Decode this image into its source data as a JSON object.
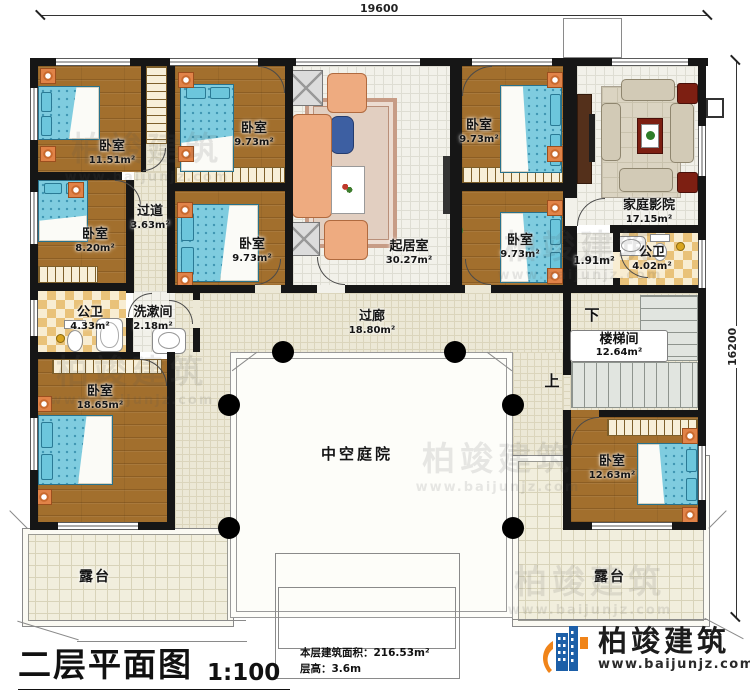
{
  "dimensions": {
    "top": "19600",
    "right": "16200"
  },
  "rooms": {
    "bedroom_tl": {
      "name": "卧室",
      "area": "11.51m²"
    },
    "bedroom_tm": {
      "name": "卧室",
      "area": "9.73m²"
    },
    "bedroom_tr": {
      "name": "卧室",
      "area": "9.73m²"
    },
    "home_theater": {
      "name": "家庭影院",
      "area": "17.15m²"
    },
    "bedroom_ml": {
      "name": "卧室",
      "area": "8.20m²"
    },
    "hallway": {
      "name": "过道",
      "area": "3.63m²"
    },
    "bedroom_mm": {
      "name": "卧室",
      "area": "9.73m²"
    },
    "living_room": {
      "name": "起居室",
      "area": "30.27m²"
    },
    "bedroom_mr": {
      "name": "卧室",
      "area": "9.73m²"
    },
    "bath_left": {
      "name": "公卫",
      "area": "4.33m²"
    },
    "washroom": {
      "name": "洗漱间",
      "area": "2.18m²"
    },
    "gallery": {
      "name": "过廊",
      "area": "18.80m²"
    },
    "vestibule": {
      "area": "1.91m²"
    },
    "bath_right": {
      "name": "公卫",
      "area": "4.02m²"
    },
    "stairwell": {
      "name": "楼梯间",
      "area": "12.64m²"
    },
    "bedroom_bl": {
      "name": "卧室",
      "area": "18.65m²"
    },
    "courtyard": {
      "name": "中空庭院"
    },
    "bedroom_br": {
      "name": "卧室",
      "area": "12.63m²"
    },
    "terrace_left": {
      "name": "露台"
    },
    "terrace_right": {
      "name": "露台"
    }
  },
  "stairs": {
    "down": "下",
    "up": "上"
  },
  "title_block": {
    "title": "二层平面图",
    "scale": "1:100",
    "area_label": "本层建筑面积：",
    "area_value": "216.53m²",
    "height_label": "层高：",
    "height_value": "3.6m"
  },
  "branding": {
    "company": "柏竣建筑",
    "website": "www.baijunjz.com"
  },
  "watermark": {
    "text": "柏竣建筑",
    "subtext": "www.baijunjz.com"
  },
  "colors": {
    "wall": "#161616",
    "wood": "#a26f2d",
    "logo_blue": "#1c5fa8",
    "logo_orange": "#f08419"
  }
}
